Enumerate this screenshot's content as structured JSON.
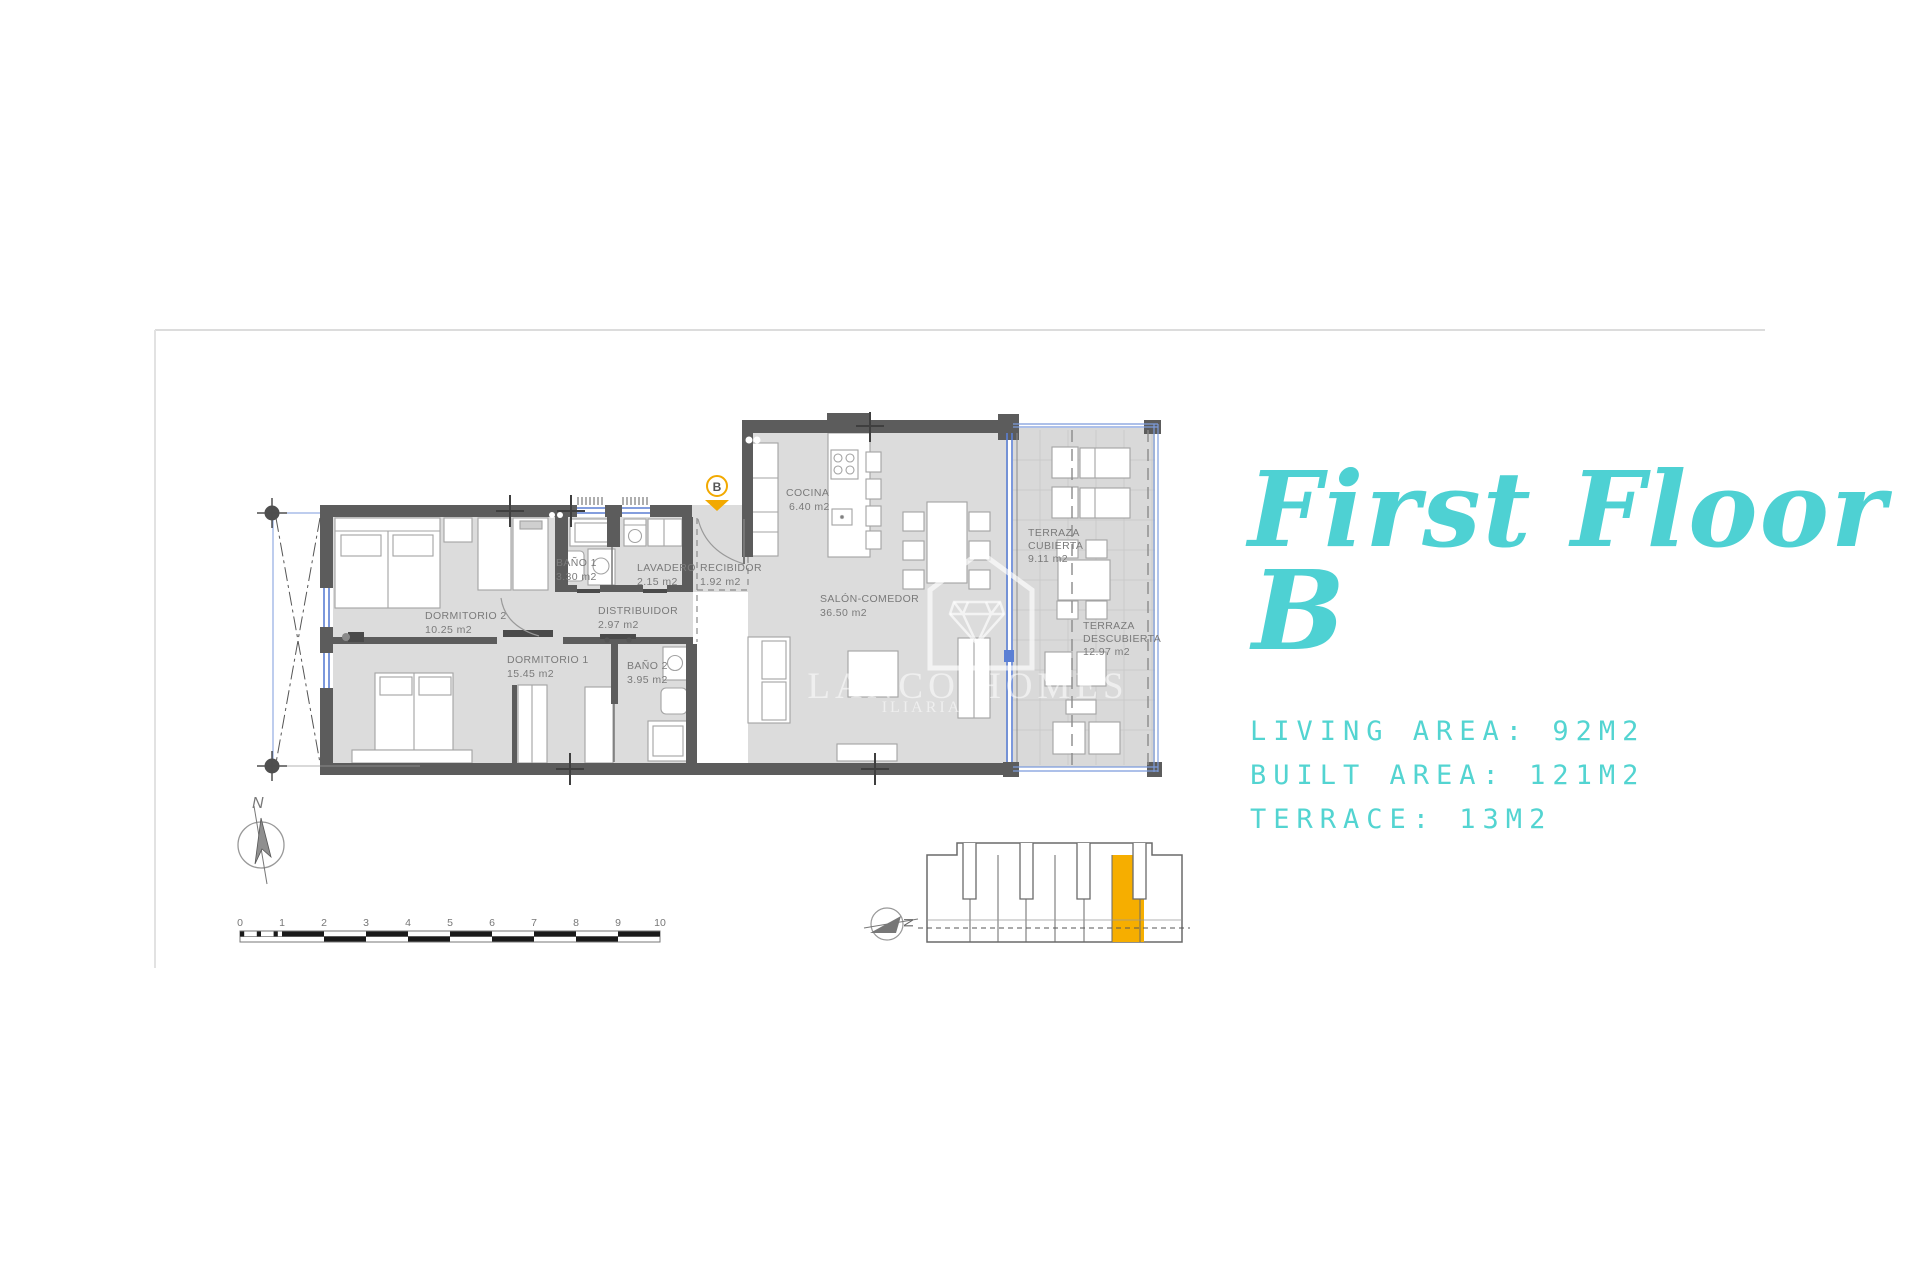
{
  "title": {
    "line1": "First Floor",
    "line2": "B"
  },
  "stats": {
    "living": "LIVING AREA: 92M2",
    "built": "BUILT AREA: 121M2",
    "terrace": "TERRACE: 13M2"
  },
  "plan": {
    "entry_badge": "B",
    "rooms": [
      {
        "name": "DORMITORIO 2",
        "area": "10.25 m2"
      },
      {
        "name": "DORMITORIO 1",
        "area": "15.45 m2"
      },
      {
        "name": "BAÑO 1",
        "area": "3.30 m2"
      },
      {
        "name": "BAÑO 2",
        "area": "3.95 m2"
      },
      {
        "name": "LAVADERO",
        "area": "2.15 m2"
      },
      {
        "name": "RECIBIDOR",
        "area": "1.92 m2"
      },
      {
        "name": "DISTRIBUIDOR",
        "area": "2.97 m2"
      },
      {
        "name": "COCINA",
        "area": "6.40 m2"
      },
      {
        "name": "SALÓN-COMEDOR",
        "area": "36.50 m2"
      },
      {
        "name1": "TERRAZA",
        "name2": "CUBIERTA",
        "area": "9.11 m2"
      },
      {
        "name1": "TERRAZA",
        "name2": "DESCUBIERTA",
        "area": "12.97 m2"
      }
    ],
    "watermark": {
      "line1": "LANCO HOMES",
      "line2": "ILIARIA"
    },
    "compass_label": "N"
  },
  "scalebar": {
    "labels": [
      "0",
      "1",
      "2",
      "3",
      "4",
      "5",
      "6",
      "7",
      "8",
      "9",
      "10"
    ]
  },
  "keyplan": {
    "compass_label": "N",
    "highlight_color": "#F6AE00"
  },
  "colors": {
    "teal": "#4ED1D3",
    "amber": "#F2A900",
    "wall": "#5C5C5C"
  }
}
